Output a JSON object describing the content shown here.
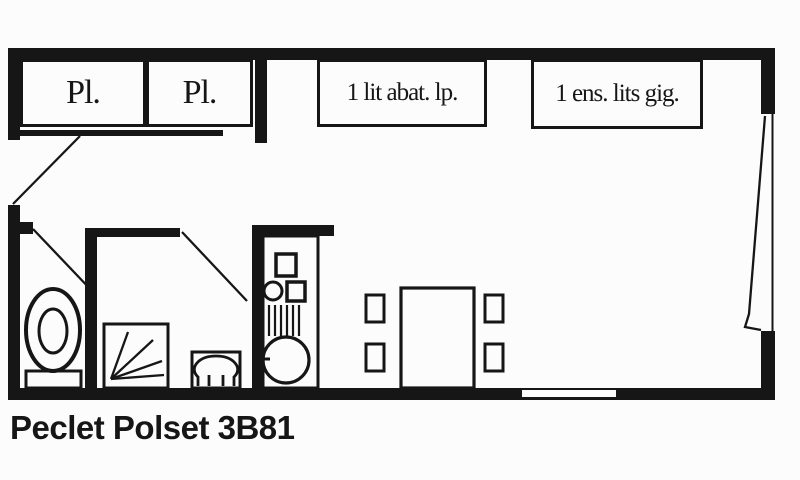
{
  "title": "Peclet Polset 3B81",
  "colors": {
    "ink": "#161616",
    "paper": "#fcfcfc"
  },
  "floorplan": {
    "closets": [
      {
        "label": "Pl."
      },
      {
        "label": "Pl."
      }
    ],
    "beds": [
      {
        "label": "1 lit abat. lp."
      },
      {
        "label": "1 ens. lits gig."
      }
    ],
    "symbols": {
      "fixtures": [
        "toilet",
        "shower",
        "washbasin",
        "kitchenette",
        "cooktop",
        "grill",
        "kitchen-sink",
        "dining-table",
        "chair"
      ],
      "doors": [
        "entry-door",
        "wc-door",
        "bathroom-door",
        "balcony-door"
      ],
      "windows": [
        "living-room-window"
      ]
    }
  }
}
